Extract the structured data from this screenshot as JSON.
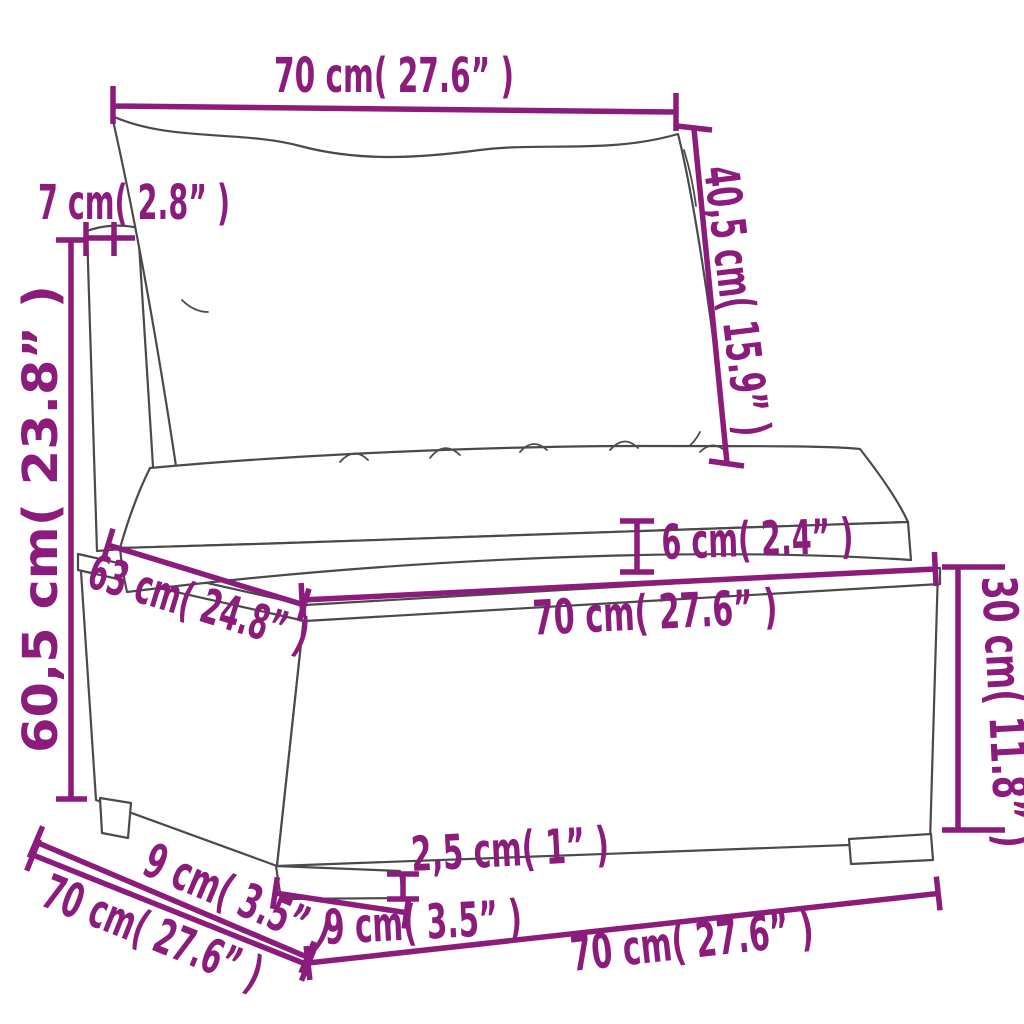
{
  "diagram": {
    "type": "product-dimension-diagram",
    "subject": "poly-rattan garden sofa middle section with cushions",
    "dimensions": {
      "back_width_top": "70 cm( 27.6” )",
      "back_cushion_height": "40,5 cm( 15.9” )",
      "back_panel_thickness": "7 cm( 2.8” )",
      "total_height": "60,5 cm( 23.8” )",
      "seat_depth": "63 cm( 24.8” )",
      "seat_cushion_thickness": "6 cm( 2.4” )",
      "seat_width": "70 cm( 27.6” )",
      "base_height": "30 cm( 11.8” )",
      "leg_offset_depth": "9 cm( 3.5” )",
      "depth_total": "70 cm( 27.6” )",
      "leg_height": "2,5 cm( 1” )",
      "leg_width": "9 cm( 3.5” )",
      "width_total_bottom": "70 cm( 27.6” )"
    }
  },
  "colors": {
    "dimension_accent": "#8b1c7c",
    "line_art": "#4a4a4a",
    "background": "#ffffff"
  }
}
